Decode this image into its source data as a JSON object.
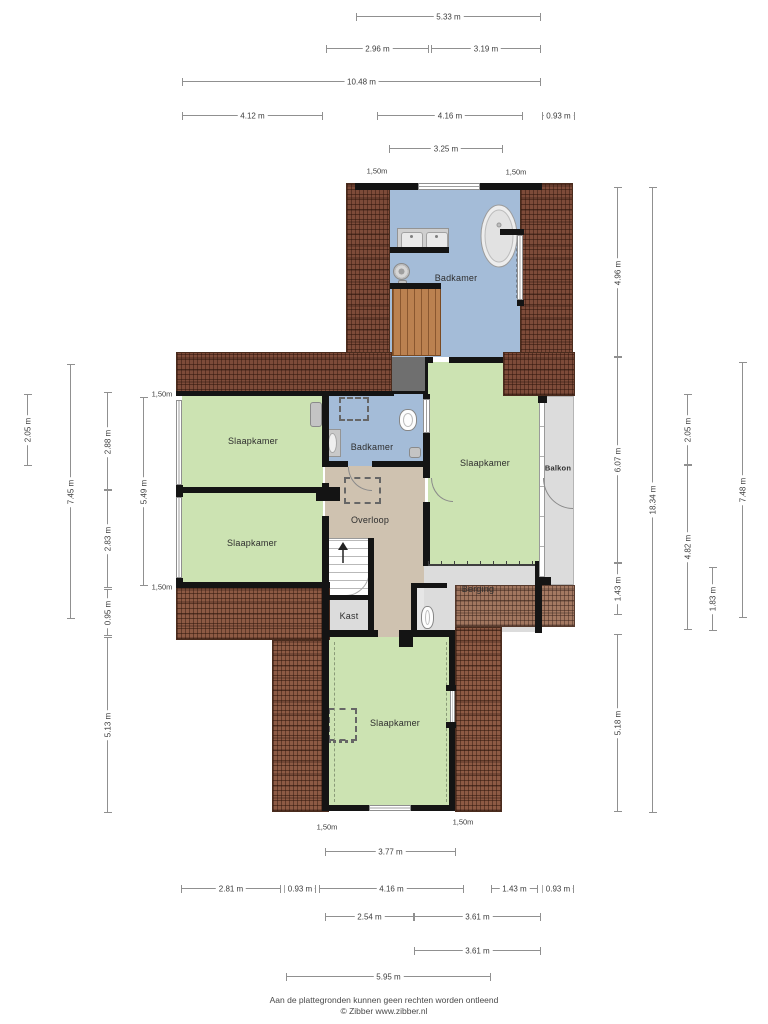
{
  "rooms": {
    "badkamer_top": {
      "label": "Badkamer"
    },
    "slaapkamer_nw": {
      "label": "Slaapkamer"
    },
    "slaapkamer_sw": {
      "label": "Slaapkamer"
    },
    "badkamer_mid": {
      "label": "Badkamer"
    },
    "slaapkamer_e": {
      "label": "Slaapkamer"
    },
    "balkon": {
      "label": "Balkon"
    },
    "overloop": {
      "label": "Overloop"
    },
    "berging": {
      "label": "Berging"
    },
    "kast": {
      "label": "Kast"
    },
    "slaapkamer_s": {
      "label": "Slaapkamer"
    }
  },
  "dimensions": {
    "horizontal": [
      {
        "label": "5.33 m",
        "x": 357,
        "y": 16,
        "len": 183
      },
      {
        "label": "2.96 m",
        "x": 327,
        "y": 48,
        "len": 101
      },
      {
        "label": "3.19 m",
        "x": 432,
        "y": 48,
        "len": 108
      },
      {
        "label": "10.48 m",
        "x": 183,
        "y": 81,
        "len": 357
      },
      {
        "label": "4.12 m",
        "x": 183,
        "y": 115,
        "len": 139
      },
      {
        "label": "4.16 m",
        "x": 378,
        "y": 115,
        "len": 144
      },
      {
        "label": "0.93 m",
        "x": 543,
        "y": 115,
        "len": 31
      },
      {
        "label": "3.25 m",
        "x": 390,
        "y": 148,
        "len": 112
      },
      {
        "label": "3.77 m",
        "x": 326,
        "y": 851,
        "len": 129
      },
      {
        "label": "2.81 m",
        "x": 182,
        "y": 888,
        "len": 98
      },
      {
        "label": "0.93 m",
        "x": 285,
        "y": 888,
        "len": 30
      },
      {
        "label": "4.16 m",
        "x": 320,
        "y": 888,
        "len": 143
      },
      {
        "label": "1.43 m",
        "x": 492,
        "y": 888,
        "len": 45
      },
      {
        "label": "0.93 m",
        "x": 543,
        "y": 888,
        "len": 30
      },
      {
        "label": "2.54 m",
        "x": 326,
        "y": 916,
        "len": 87
      },
      {
        "label": "3.61 m",
        "x": 415,
        "y": 916,
        "len": 125
      },
      {
        "label": "3.61 m",
        "x": 415,
        "y": 950,
        "len": 125
      },
      {
        "label": "5.95 m",
        "x": 287,
        "y": 976,
        "len": 203
      }
    ],
    "vertical": [
      {
        "label": "2.05 m",
        "x": 27,
        "y": 395,
        "len": 70
      },
      {
        "label": "7.45 m",
        "x": 70,
        "y": 365,
        "len": 253
      },
      {
        "label": "2.88 m",
        "x": 107,
        "y": 393,
        "len": 97
      },
      {
        "label": "2.83 m",
        "x": 107,
        "y": 490,
        "len": 97
      },
      {
        "label": "0.95 m",
        "x": 107,
        "y": 590,
        "len": 45
      },
      {
        "label": "5.13 m",
        "x": 107,
        "y": 638,
        "len": 174
      },
      {
        "label": "5.49 m",
        "x": 143,
        "y": 398,
        "len": 187
      },
      {
        "label": "4.96 m",
        "x": 617,
        "y": 188,
        "len": 169
      },
      {
        "label": "6.07 m",
        "x": 617,
        "y": 357,
        "len": 206
      },
      {
        "label": "1.43 m",
        "x": 617,
        "y": 563,
        "len": 51
      },
      {
        "label": "5.18 m",
        "x": 617,
        "y": 635,
        "len": 176
      },
      {
        "label": "18.34 m",
        "x": 652,
        "y": 188,
        "len": 624
      },
      {
        "label": "2.05 m",
        "x": 687,
        "y": 395,
        "len": 70
      },
      {
        "label": "4.82 m",
        "x": 687,
        "y": 465,
        "len": 164
      },
      {
        "label": "1.83 m",
        "x": 712,
        "y": 568,
        "len": 62
      },
      {
        "label": "7.48 m",
        "x": 742,
        "y": 363,
        "len": 254
      }
    ],
    "height_markers": [
      {
        "label": "1,50m",
        "x": 377,
        "y": 171
      },
      {
        "label": "1,50m",
        "x": 516,
        "y": 172
      },
      {
        "label": "1,50m",
        "x": 162,
        "y": 394
      },
      {
        "label": "1,50m",
        "x": 162,
        "y": 587
      },
      {
        "label": "1,50m",
        "x": 327,
        "y": 827
      },
      {
        "label": "1,50m",
        "x": 463,
        "y": 822
      }
    ]
  },
  "footer": {
    "line1": "Aan de plattegronden kunnen geen rechten worden ontleend",
    "line2": "© Zibber www.zibber.nl"
  },
  "colors": {
    "bedroom": "#cce3b2",
    "bathroom": "#a4bcd8",
    "hall": "#cfc2b0",
    "grey_room": "#dcdcdc",
    "roof_dark": "#7d4b39",
    "roof_mid": "#8d5a44",
    "roof_light": "#9d6e55",
    "wood": "#bb8150",
    "wall": "#141414",
    "void": "#6f6f6f"
  }
}
